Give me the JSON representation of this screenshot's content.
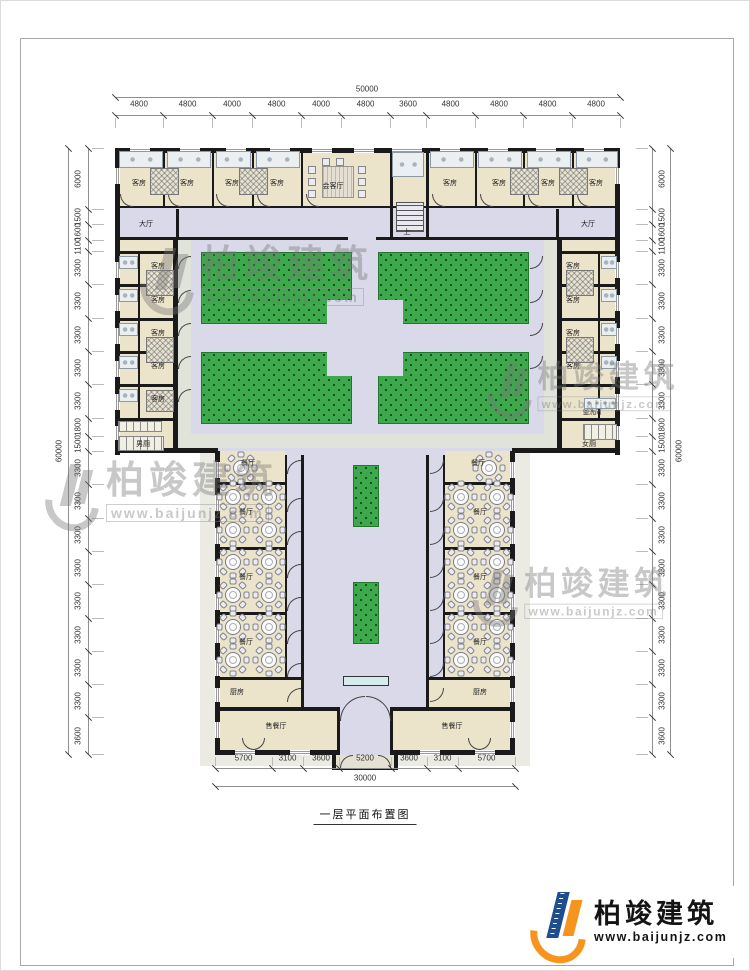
{
  "title_block": {
    "title": "一层平面布置图"
  },
  "brand": {
    "name": "柏竣建筑",
    "url": "www.baijunjz.com"
  },
  "watermark": {
    "name": "柏竣建筑",
    "url": "www.baijunjz.com"
  },
  "dims": {
    "top_total": "50000",
    "top": [
      "4800",
      "4800",
      "4000",
      "4800",
      "4000",
      "4800",
      "3600",
      "4800",
      "4800",
      "4800",
      "4800"
    ],
    "side_total": "60000",
    "side": [
      "6000",
      "1500",
      "1600",
      "1100",
      "3300",
      "3300",
      "3300",
      "3300",
      "3300",
      "1800",
      "1500",
      "3300",
      "3300",
      "3300",
      "3300",
      "3300",
      "3300",
      "3300",
      "3300",
      "3600"
    ],
    "bottom_total": "30000",
    "bottom": [
      "5700",
      "3100",
      "3600",
      "5200",
      "3600",
      "3100",
      "5700"
    ]
  },
  "rooms": {
    "guest": "客房",
    "reception": "会客厅",
    "up": "上",
    "hall": "大厅",
    "mens": "男厕",
    "womens": "女厕",
    "wash": "盥洗间",
    "dining": "餐厅",
    "kitchen": "厨房",
    "sales": "售餐厅"
  },
  "colors": {
    "wall": "#1a1a1a",
    "room": "#ebe3ca",
    "corridor": "#d9d9e9",
    "walkway": "#dfe3da",
    "lawn": "#3da94c",
    "sidewalk": "#ebebe4",
    "brand_blue": "#1e4e8e",
    "brand_orange": "#f7941d"
  }
}
